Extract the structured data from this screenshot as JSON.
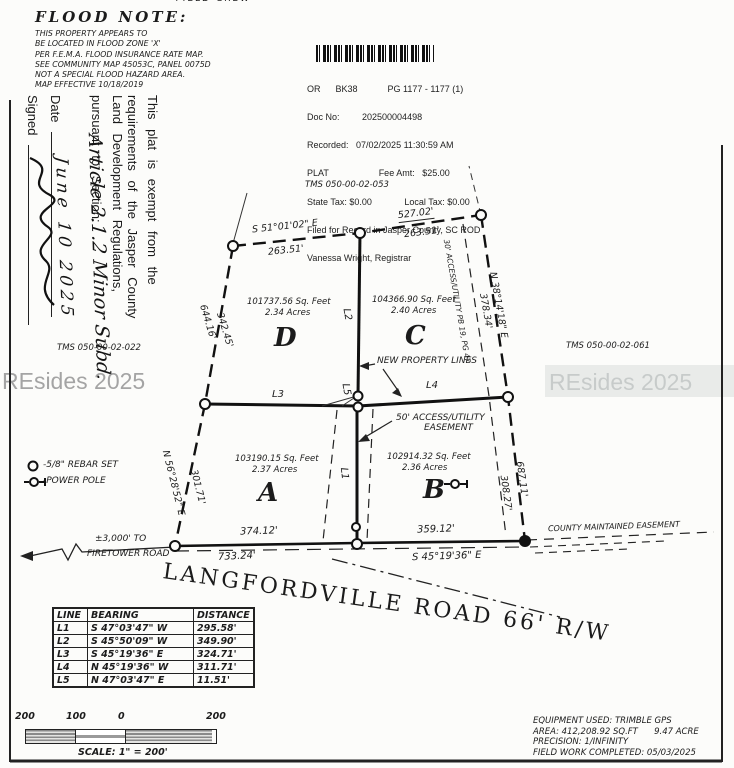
{
  "top_edge_fragment": "FIELD CREW",
  "flood_note": {
    "title": "FLOOD NOTE:",
    "lines": [
      "THIS PROPERTY APPEARS TO",
      "BE LOCATED IN FLOOD ZONE 'X'",
      "PER F.E.M.A. FLOOD INSURANCE RATE MAP.",
      "SEE COMMUNITY MAP 45053C, PANEL 0075D",
      "NOT A SPECIAL FLOOD HAZARD AREA.",
      "MAP EFFECTIVE 10/18/2019"
    ]
  },
  "stamp": {
    "lines": [
      "OR      BK38            PG 1177 - 1177 (1)",
      "Doc No:         202500004498",
      "Recorded:   07/02/2025 11:30:59 AM",
      "PLAT                    Fee Amt:   $25.00",
      "State Tax: $0.00             Local Tax: $0.00",
      "Filed for Record in Jasper County, SC ROD",
      "Vanessa Wright, Registrar"
    ]
  },
  "exemption": {
    "line1": "This plat is exempt from the",
    "line2": "requirements of the Jasper County",
    "line3": "Land Development Regulations,",
    "line4": "pursuant to Section:",
    "section_handwriting": "Article 2.1.2 Minor Subd.",
    "date_label": "Date",
    "date_handwriting": "June 10 2025",
    "signed_label": "Signed"
  },
  "tms_labels": {
    "top": "TMS 050-00-02-053",
    "left": "TMS 050-00-02-022",
    "right": "TMS 050-00-02-061"
  },
  "watermark": "REsides 2025",
  "parcels": {
    "d": {
      "name": "D",
      "sqft": "101737.56 Sq. Feet",
      "acres": "2.34 Acres"
    },
    "c": {
      "name": "C",
      "sqft": "104366.90 Sq. Feet",
      "acres": "2.40 Acres"
    },
    "a": {
      "name": "A",
      "sqft": "103190.15 Sq. Feet",
      "acres": "2.37 Acres"
    },
    "b": {
      "name": "B",
      "sqft": "102914.32 Sq. Feet",
      "acres": "2.36 Acres"
    }
  },
  "dimensions": {
    "top_left_bearing": "S 51°01'02\" E",
    "top_left_distance": "263.51'",
    "top_right_total": "527.02'",
    "top_right_distance": "263.51'",
    "left_upper_total": "644.16'",
    "left_upper_distance": "342.45'",
    "left_lower_bearing": "N 56°28'52\" E",
    "left_lower_distance": "301.71'",
    "right_upper_bearing": "N 38°14'18\" E",
    "right_upper_distance": "378.34'",
    "right_easement_note": "30' ACCESS/UTILITY PB 19, PG 47",
    "right_lower_total": "687.11'",
    "right_lower_distance": "308.27'",
    "bottom_left_distance": "374.12'",
    "bottom_right_distance": "359.12'",
    "bottom_total": "733.24'",
    "bottom_bearing": "S 45°19'36\" E",
    "l1": "L1",
    "l2": "L2",
    "l3": "L3",
    "l4": "L4",
    "l5": "L5"
  },
  "annotations": {
    "new_property_lines": "NEW PROPERTY LINES",
    "easement_line1": "50' ACCESS/UTILITY",
    "easement_line2": "EASEMENT",
    "firetower_line1": "±3,000' TO",
    "firetower_line2": "FIRETOWER ROAD",
    "county_easement": "COUNTY MAINTAINED EASEMENT",
    "road_label": "LANGFORDVILLE ROAD 66' R/W"
  },
  "legend": {
    "rebar": "-5/8\" REBAR SET",
    "power_pole": "-POWER POLE"
  },
  "line_table": {
    "headers": [
      "LINE",
      "BEARING",
      "DISTANCE"
    ],
    "rows": [
      [
        "L1",
        "S 47°03'47\" W",
        "295.58'"
      ],
      [
        "L2",
        "S 45°50'09\" W",
        "349.90'"
      ],
      [
        "L3",
        "S 45°19'36\" E",
        "324.71'"
      ],
      [
        "L4",
        "N 45°19'36\" W",
        "311.71'"
      ],
      [
        "L5",
        "N 47°03'47\" E",
        "11.51'"
      ]
    ]
  },
  "scale_bar": {
    "labels": [
      "200",
      "100",
      "0",
      "200"
    ],
    "caption": "SCALE: 1\" = 200'"
  },
  "survey_info": {
    "equipment": "EQUIPMENT USED: TRIMBLE GPS",
    "area": "AREA: 412,208.92 SQ.FT      9.47 ACRE",
    "precision": "PRECISION: 1/INFINITY",
    "field_work": "FIELD WORK COMPLETED: 05/03/2025"
  },
  "colors": {
    "ink": "#1b1b1b",
    "watermark_left": "#8f8f8f",
    "watermark_right": "#c7cbca"
  }
}
